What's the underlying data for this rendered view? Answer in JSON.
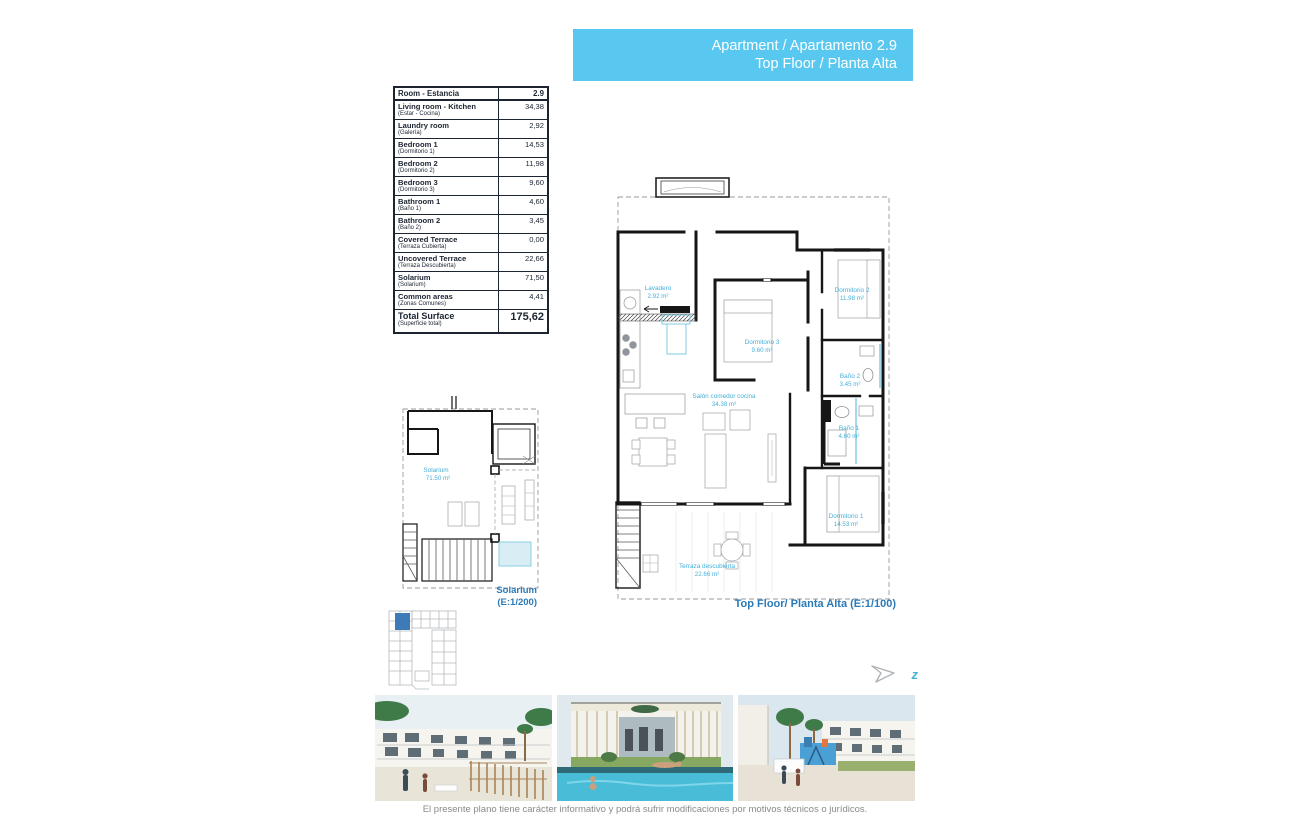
{
  "header": {
    "line1": "Apartment / Apartamento 2.9",
    "line2": "Top Floor / Planta Alta"
  },
  "table": {
    "header": {
      "name": "Room - Estancia",
      "value": "2.9"
    },
    "rows": [
      {
        "name": "Living room - Kitchen",
        "sub": "(Estar - Cocina)",
        "value": "34,38"
      },
      {
        "name": "Laundry room",
        "sub": "(Galería)",
        "value": "2,92"
      },
      {
        "name": "Bedroom 1",
        "sub": "(Dormitorio 1)",
        "value": "14,53"
      },
      {
        "name": "Bedroom 2",
        "sub": "(Dormitorio 2)",
        "value": "11,98"
      },
      {
        "name": "Bedroom 3",
        "sub": "(Dormitorio 3)",
        "value": "9,60"
      },
      {
        "name": "Bathroom 1",
        "sub": "(Baño 1)",
        "value": "4,60"
      },
      {
        "name": "Bathroom 2",
        "sub": "(Baño 2)",
        "value": "3,45"
      },
      {
        "name": "Covered Terrace",
        "sub": "(Terraza Cubierta)",
        "value": "0,00"
      },
      {
        "name": "Uncovered Terrace",
        "sub": "(Terraza Descubierta)",
        "value": "22,66"
      },
      {
        "name": "Solarium",
        "sub": "(Solarium)",
        "value": "71,50"
      },
      {
        "name": "Common areas",
        "sub": "(Zonas Comunes)",
        "value": "4,41"
      }
    ],
    "total": {
      "name": "Total Surface",
      "sub": "(Superficie total)",
      "value": "175,62"
    }
  },
  "floor_plan": {
    "caption": "Top Floor/ Planta Alta (E:1/100)",
    "rooms": {
      "lavadero": {
        "name": "Lavadero",
        "area": "2.92 m²"
      },
      "dorm3": {
        "name": "Dormitorio 3",
        "area": "9.60 m²"
      },
      "dorm2": {
        "name": "Dormitorio 2",
        "area": "11.98 m²"
      },
      "bano2": {
        "name": "Baño 2",
        "area": "3.45 m²"
      },
      "bano1": {
        "name": "Baño 1",
        "area": "4.60 m²"
      },
      "dorm1": {
        "name": "Dormitorio 1",
        "area": "14.53 m²"
      },
      "salon": {
        "name": "Salón comedor cocina",
        "area": "34.38 m²"
      },
      "terraza": {
        "name": "Terraza descubierta",
        "area": "22.66 m²"
      }
    }
  },
  "solarium_plan": {
    "label": {
      "name": "Solarium",
      "area": "71.50 m²"
    },
    "caption_line1": "Solarium",
    "caption_line2": "(E:1/200)"
  },
  "north_arrow": {
    "letter": "z"
  },
  "footer": {
    "disclaimer": "El presente plano tiene carácter informativo y podrá sufrir modificaciones por motivos técnicos o jurídicos."
  },
  "colors": {
    "header_bg": "#59c8f0",
    "plan_label": "#45b0d8",
    "caption_blue": "#2b7ab8",
    "keyplan_highlight": "#3c7ab8",
    "pool": "#49bcd8"
  }
}
